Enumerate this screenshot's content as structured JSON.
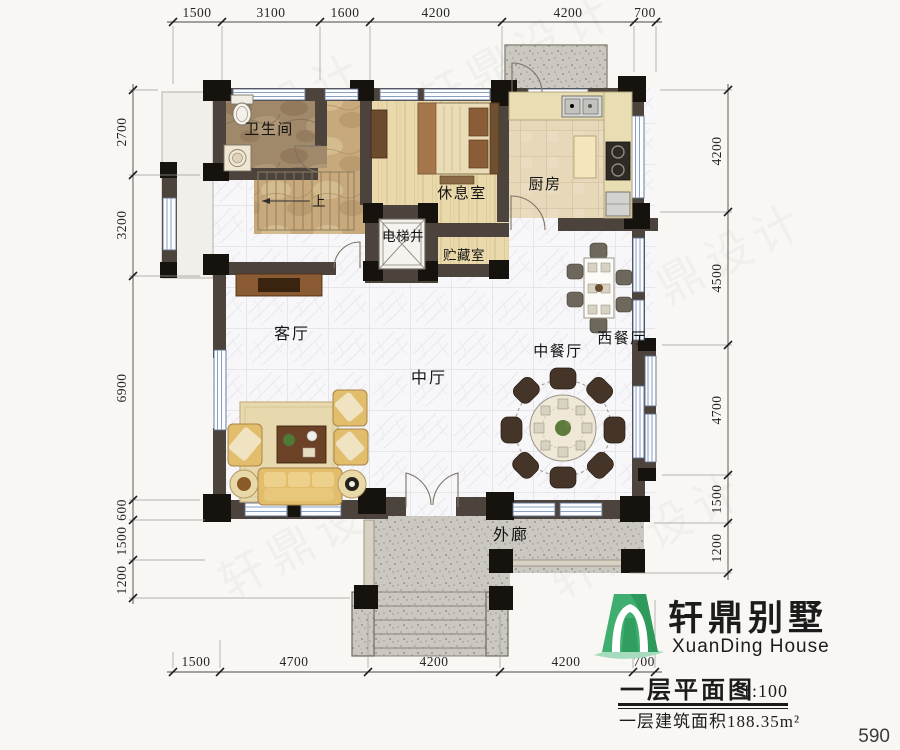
{
  "page": {
    "page_number": "590",
    "background": "#f9f7f3"
  },
  "watermark": {
    "text": "轩鼎设计"
  },
  "logo": {
    "name_cn": "轩鼎别墅",
    "name_en": "XuanDing House",
    "green_dark": "#2f9e5f",
    "green_light": "#8ccfa8"
  },
  "title_block": {
    "title": "一层平面图",
    "scale": "1:100",
    "area_note": "一层建筑面积188.35m²"
  },
  "plan": {
    "wall_color": "#4b433c",
    "stair_up_label": "上",
    "rooms": [
      {
        "id": "bathroom",
        "label": "卫生间"
      },
      {
        "id": "lounge",
        "label": "休息室"
      },
      {
        "id": "kitchen",
        "label": "厨房"
      },
      {
        "id": "elevator",
        "label": "电梯井"
      },
      {
        "id": "storage",
        "label": "贮藏室"
      },
      {
        "id": "living",
        "label": "客厅"
      },
      {
        "id": "hall",
        "label": "中厅"
      },
      {
        "id": "dining-cn",
        "label": "中餐厅"
      },
      {
        "id": "dining-west",
        "label": "西餐厅"
      },
      {
        "id": "veranda",
        "label": "外廊"
      }
    ],
    "dimensions": {
      "top": [
        "1500",
        "3100",
        "1600",
        "4200",
        "4200",
        "700"
      ],
      "bottom": [
        "1500",
        "4700",
        "4200",
        "4200",
        "700"
      ],
      "left": [
        "2700",
        "3200",
        "6900",
        "600",
        "1500",
        "1200"
      ],
      "right": [
        "4200",
        "4500",
        "4700",
        "1500",
        "1200"
      ]
    }
  }
}
